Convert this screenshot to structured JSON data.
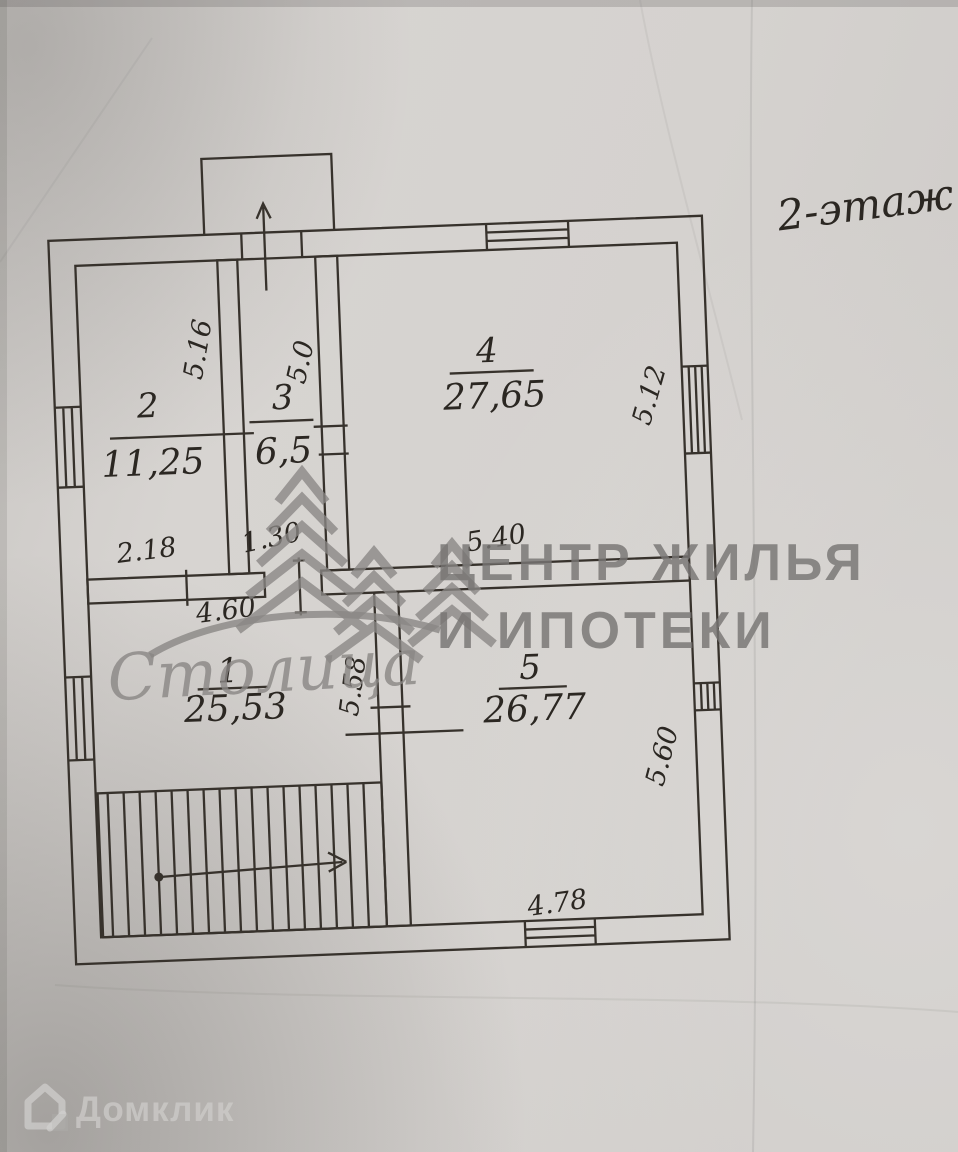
{
  "photo": {
    "floor_label": "2-этаж"
  },
  "plan": {
    "rooms": [
      {
        "number": "2",
        "area": "11,25"
      },
      {
        "number": "3",
        "area": "6,5"
      },
      {
        "number": "4",
        "area": "27,65"
      },
      {
        "number": "1",
        "area": "25,53"
      },
      {
        "number": "5",
        "area": "26,77"
      }
    ],
    "dimensions": [
      "5.16",
      "5.0",
      "5.12",
      "2.18",
      "1.30",
      "5.40",
      "4.60",
      "5.58",
      "5.60",
      "4.78"
    ]
  },
  "watermarks": {
    "agency_line1": "ЦЕНТР ЖИЛЬЯ",
    "agency_line2": "И ИПОТЕКИ",
    "agency_brand": "Столица",
    "portal_brand": "Домклик"
  },
  "colors": {
    "ink": "#332f2a",
    "paper": "#d5d2cf",
    "watermark_gray": "#8a8785",
    "agency_text_gray": "#787674",
    "portal_text": "#cfcdcb"
  }
}
